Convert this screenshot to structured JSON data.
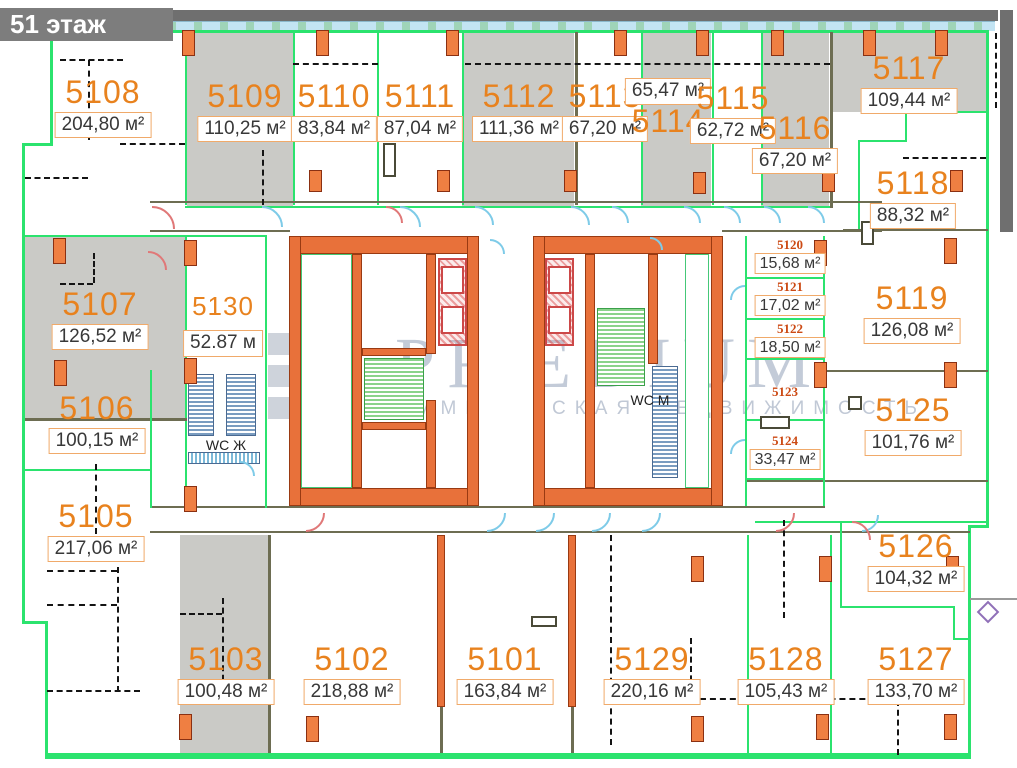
{
  "header": {
    "title": "51 этаж"
  },
  "watermark": {
    "brand": "PRÆDIUM",
    "tagline": "КОММЕРЧЕСКАЯ НЕДВИЖИМОСТЬ"
  },
  "wc": {
    "women": "WC Ж",
    "men": "WC М"
  },
  "units": [
    {
      "number": "5101",
      "area": "163,84 м²"
    },
    {
      "number": "5102",
      "area": "218,88 м²"
    },
    {
      "number": "5103",
      "area": "100,48 м²"
    },
    {
      "number": "5105",
      "area": "217,06 м²"
    },
    {
      "number": "5106",
      "area": "100,15 м²"
    },
    {
      "number": "5107",
      "area": "126,52 м²"
    },
    {
      "number": "5108",
      "area": "204,80 м²"
    },
    {
      "number": "5109",
      "area": "110,25 м²"
    },
    {
      "number": "5110",
      "area": "83,84 м²"
    },
    {
      "number": "5111",
      "area": "87,04 м²"
    },
    {
      "number": "5112",
      "area": "111,36 м²"
    },
    {
      "number": "5113",
      "area": "67,20 м²"
    },
    {
      "number": "5114",
      "area": "65,47 м²"
    },
    {
      "number": "5115",
      "area": "62,72 м²"
    },
    {
      "number": "5116",
      "area": "67,20 м²"
    },
    {
      "number": "5117",
      "area": "109,44 м²"
    },
    {
      "number": "5118",
      "area": "88,32 м²"
    },
    {
      "number": "5119",
      "area": "126,08 м²"
    },
    {
      "number": "5120",
      "area": "15,68 м²"
    },
    {
      "number": "5121",
      "area": "17,02 м²"
    },
    {
      "number": "5122",
      "area": "18,50 м²"
    },
    {
      "number": "5123",
      "area": ""
    },
    {
      "number": "5124",
      "area": "33,47 м²"
    },
    {
      "number": "5125",
      "area": "101,76 м²"
    },
    {
      "number": "5126",
      "area": "104,32 м²"
    },
    {
      "number": "5127",
      "area": "133,70 м²"
    },
    {
      "number": "5128",
      "area": "105,43 м²"
    },
    {
      "number": "5129",
      "area": "220,16 м²"
    },
    {
      "number": "5130",
      "area": "52.87 м"
    }
  ]
}
